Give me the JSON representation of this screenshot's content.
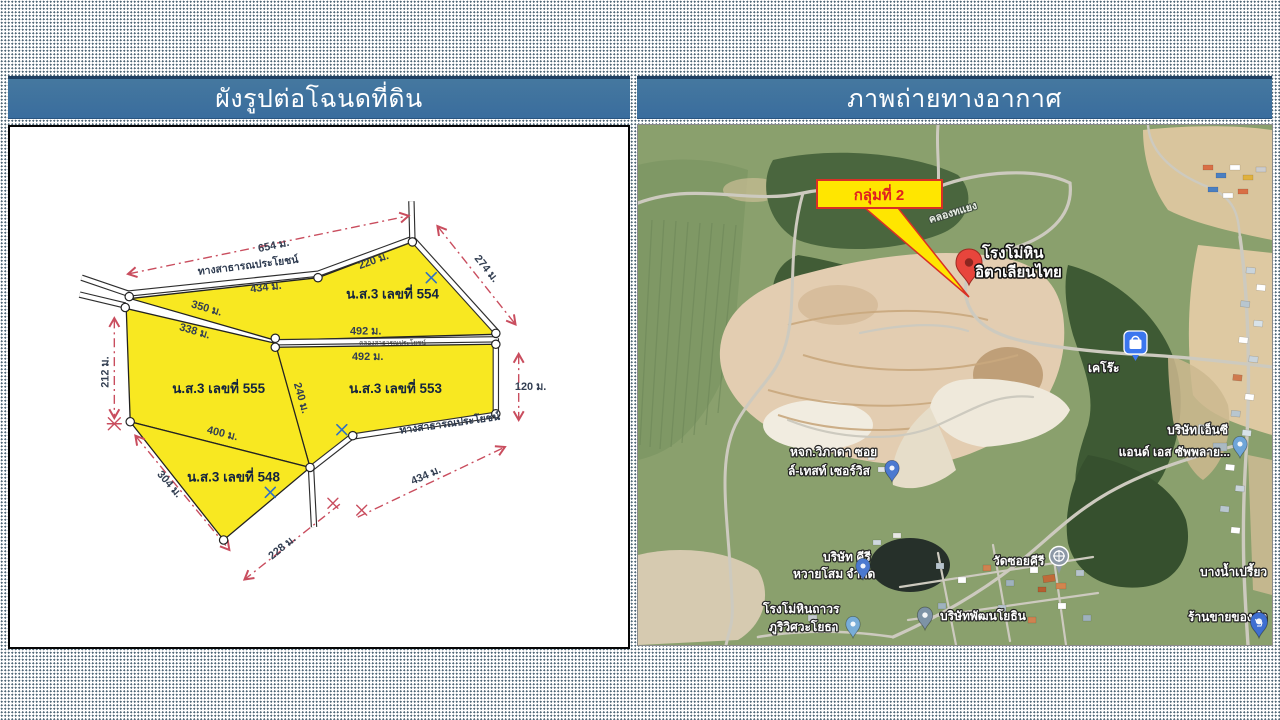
{
  "slide": {
    "left_header": "ผังรูปต่อโฉนดที่ดิน",
    "right_header": "ภาพถ่ายทางอากาศ"
  },
  "plan": {
    "road_top": "ทางสาธารณประโยชน์",
    "road_bottom": "ทางสาธารณประโยชน์",
    "canal": "คลองสาธารณประโยชน์",
    "parcel_554": "น.ส.3 เลขที่ 554",
    "parcel_555": "น.ส.3 เลขที่ 555",
    "parcel_553": "น.ส.3 เลขที่ 553",
    "parcel_548": "น.ส.3 เลขที่ 548",
    "dims": {
      "d654": "654 ม.",
      "d434_top": "434 ม.",
      "d220": "220 ม.",
      "d274": "274 ม.",
      "d350": "350 ม.",
      "d338": "338 ม.",
      "d212": "212 ม.",
      "d492_top": "492 ม.",
      "d492_bottom": "492 ม.",
      "d120": "120 ม.",
      "d240": "240 ม.",
      "d400": "400 ม.",
      "d304": "304 ม.",
      "d228": "228 ม.",
      "d434_bottom": "434 ม."
    }
  },
  "aerial": {
    "callout": "กลุ่มที่ 2",
    "canal_name": "คลองทแยง",
    "pin_line1": "โรงโม่หิน",
    "pin_line2": "อิตาเลียนไทย",
    "keroh": "เคโร๊ะ",
    "nc_line1": "บริษัท เอ็นซี",
    "nc_line2": "แอนด์ เอส ซัพพลาย...",
    "vipada_line1": "หจก.วิภาดา ซอย",
    "vipada_line2": "ล์-เทสท์ เซอร์วิส",
    "kiri_line1": "บริษัท คีรี",
    "kiri_line2": "หวายโสม จำกัด",
    "wat": "วัดซอยคีรี",
    "patthana": "บริษัทพัฒนโยธิน",
    "thaworn_line1": "โรงโม่หินถาวร",
    "thaworn_line2": "ภูริวิศวะโยธา",
    "bangnam": "บางน้ำเปรี้ยว",
    "shop": "ร้านขายของชำ"
  },
  "colors": {
    "header_blue": "#3a6d9e",
    "parcel_yellow": "#f8e821",
    "dim_red": "#c94d5e",
    "callout_yellow": "#ffe600",
    "callout_red": "#e02020",
    "pin_red": "#e8453c"
  }
}
